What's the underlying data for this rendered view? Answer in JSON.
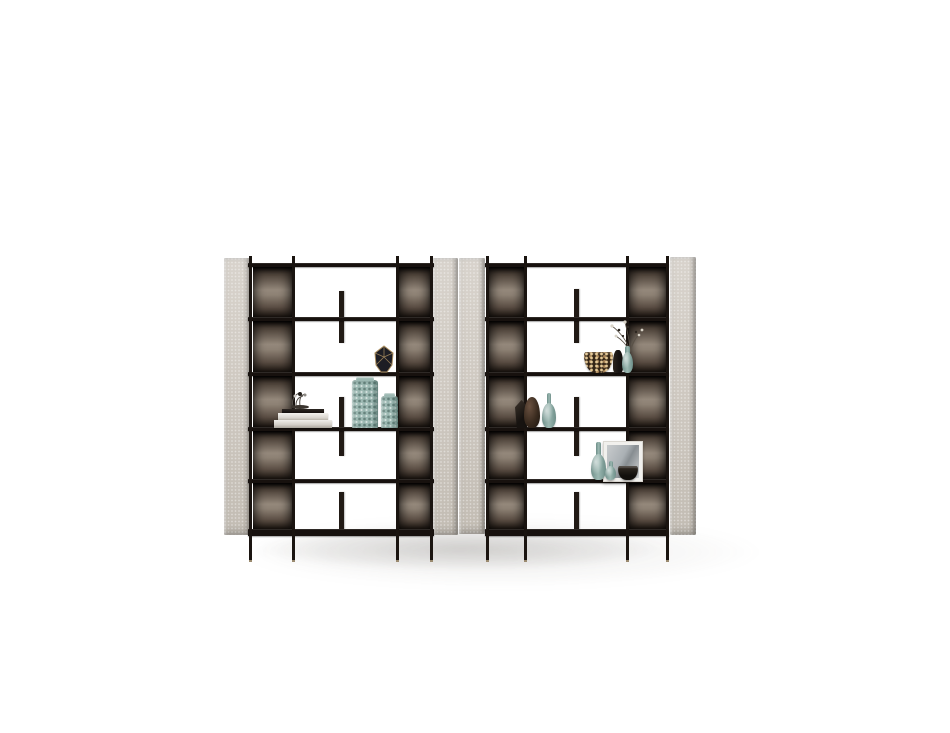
{
  "meta": {
    "type": "studio-product-photograph",
    "subject": "Two modern open shelving units (etageres) with thin black metal frames, smoked-bronze mirror back panels, light grey upholstered side panels and styled decor objects, centered on a white seamless background",
    "units_count": 2,
    "rows_per_unit": 5
  },
  "palette": {
    "bg": "#ffffff",
    "frame-dark": "#1a1410",
    "shelf-dark": "#17110e",
    "panel-grey": "#cdc7bf",
    "panel-grey-light": "#d8d3cc",
    "bronze-light": "#94887b",
    "bronze-dark": "#241c16",
    "teal-glass": "#9cb8b2",
    "teal-glass-dark": "#6e8f89",
    "gold-accent": "#a98d5f",
    "leopard-base": "#322416",
    "wood-brown": "#4a3527",
    "floor-shadow": "rgba(90,86,80,0.22)"
  },
  "units": [
    {
      "name": "left-bookcase",
      "decor": [
        {
          "label": "faceted geometric vase with gold edges",
          "shelf_row": 2
        },
        {
          "label": "stack of books with small ornament",
          "shelf_row": 3
        },
        {
          "label": "two textured teal glass vases",
          "shelf_row": 3
        }
      ]
    },
    {
      "name": "right-bookcase",
      "decor": [
        {
          "label": "animal-print decorative bowl",
          "shelf_row": 2
        },
        {
          "label": "small dark bottle",
          "shelf_row": 2
        },
        {
          "label": "teal vase with dried branches",
          "shelf_row": 2
        },
        {
          "label": "dark faceted vase",
          "shelf_row": 3
        },
        {
          "label": "brown gourd vase",
          "shelf_row": 3
        },
        {
          "label": "teal glass bottle",
          "shelf_row": 3
        },
        {
          "label": "two teal glass bottles",
          "shelf_row": 4
        },
        {
          "label": "framed art print",
          "shelf_row": 4
        },
        {
          "label": "small dark bowl",
          "shelf_row": 4
        }
      ]
    }
  ]
}
